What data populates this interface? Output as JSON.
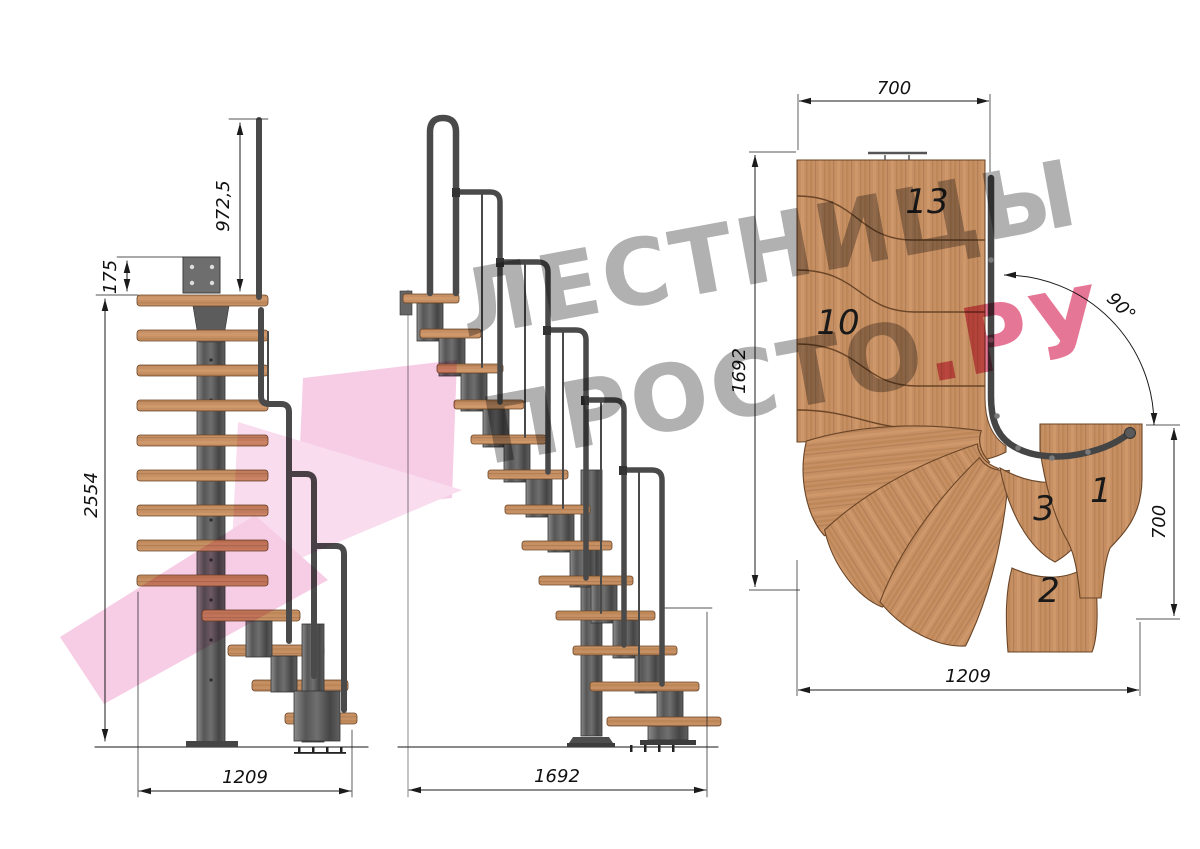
{
  "page": {
    "background": "#ffffff"
  },
  "watermark": {
    "line1": "ЛЕСТНИЦЫ",
    "line2_main": "ПРОСТО",
    "line2_accent": ".РУ",
    "text_gray": "#9d9d9d",
    "accent_pink": "#e0537b",
    "logo_pink": "#f2aed6",
    "logo_pink_light": "#f6c6e4"
  },
  "front_view": {
    "dim_handrail_height": "972,5",
    "dim_bracket_height": "175",
    "dim_total_height": "2554",
    "dim_total_width": "1209"
  },
  "side_view": {
    "dim_total_length": "1692"
  },
  "plan_view": {
    "dim_top_width": "700",
    "dim_left_length": "1692",
    "dim_turn_angle": "90°",
    "dim_right_width": "700",
    "dim_bottom_length": "1209",
    "tread_numbers": {
      "top": "13",
      "middle": "10",
      "winder": "3",
      "first": "1",
      "second": "2"
    }
  },
  "colors": {
    "wood": "#c79064",
    "wood_edge": "#6a4527",
    "metal": "#5f5f5f",
    "metal_dark": "#3a3a3a",
    "dimension_line": "#1b1b1b"
  }
}
